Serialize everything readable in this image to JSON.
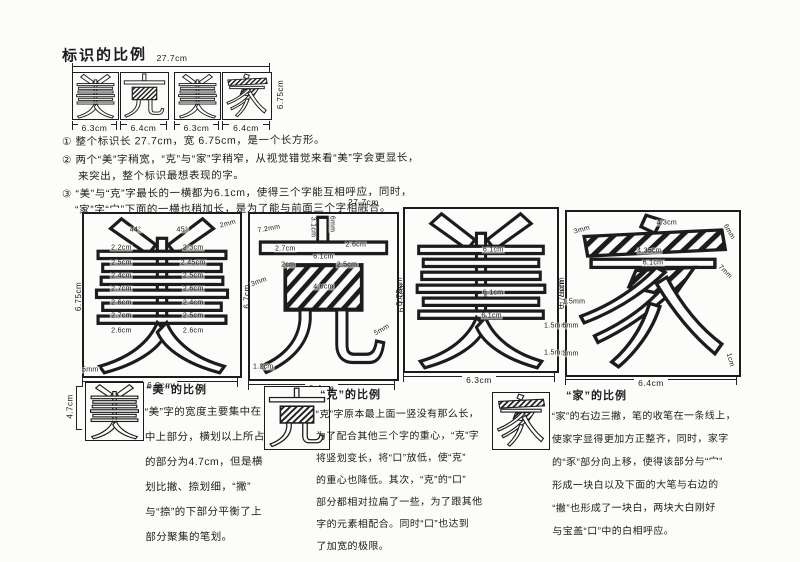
{
  "page": {
    "title": "标识的比例"
  },
  "logo_strip": {
    "width_label": "27.7cm",
    "height_label": "6.75cm",
    "characters": [
      "美",
      "克",
      "美",
      "家"
    ],
    "char_width_labels": [
      "6.3cm",
      "6.4cm",
      "6.3cm",
      "6.4cm"
    ]
  },
  "notes": {
    "n1": "① 整个标识长 27.7cm，宽 6.75cm，是一个长方形。",
    "n2a": "② 两个“美”字稍宽，“克”与“家”字稍窄，从视觉错觉来看“美”字会更显长，",
    "n2b": "来突出，整个标识最想表现的字。",
    "n3a": "③ “美”与“克”字最长的一横都为6.1cm，使得三个字能互相呼应，同时，",
    "n3b": "“家”字“宀”下面的一横也稍加长，是为了能与前面三个字相融合。",
    "n3_width": "27.7cm"
  },
  "boxes": [
    {
      "character": "美",
      "glyph": "mei",
      "left_label": "6.75cm",
      "right_label": "6.7cm",
      "bottom_label": "6.3cm",
      "labels": [
        {
          "t": "44°",
          "x": 33,
          "y": 10
        },
        {
          "t": "45°",
          "x": 63,
          "y": 10
        },
        {
          "t": "2mm",
          "x": 92,
          "y": 6,
          "r": -15
        },
        {
          "t": "2.2cm",
          "x": 24,
          "y": 21
        },
        {
          "t": "2.5cm",
          "x": 24,
          "y": 30
        },
        {
          "t": "2.4cm",
          "x": 24,
          "y": 38
        },
        {
          "t": "2.7cm",
          "x": 24,
          "y": 46
        },
        {
          "t": "2.6cm",
          "x": 24,
          "y": 55
        },
        {
          "t": "2.7cm",
          "x": 24,
          "y": 63
        },
        {
          "t": "2.6cm",
          "x": 24,
          "y": 72
        },
        {
          "t": "2.3cm",
          "x": 70,
          "y": 21
        },
        {
          "t": "2.45cm",
          "x": 70,
          "y": 30
        },
        {
          "t": "2.5cm",
          "x": 70,
          "y": 38
        },
        {
          "t": "2.6cm",
          "x": 70,
          "y": 46
        },
        {
          "t": "2.4cm",
          "x": 70,
          "y": 55
        },
        {
          "t": "2.5cm",
          "x": 70,
          "y": 63
        },
        {
          "t": "2.6cm",
          "x": 70,
          "y": 72
        },
        {
          "t": "5mm",
          "x": 4,
          "y": 96
        }
      ]
    },
    {
      "character": "克",
      "glyph": "ke",
      "right_label": "6.75cm",
      "bottom_label": "6.4cm",
      "labels": [
        {
          "t": "7.2mm",
          "x": 13,
          "y": 9,
          "r": -10
        },
        {
          "t": "3.1cm",
          "x": 43,
          "y": 8,
          "r": 90
        },
        {
          "t": "6mm",
          "x": 56,
          "y": 6,
          "r": 90
        },
        {
          "t": "2.7cm",
          "x": 24,
          "y": 21
        },
        {
          "t": "2.6cm",
          "x": 72,
          "y": 19
        },
        {
          "t": "6.1cm",
          "x": 50,
          "y": 26
        },
        {
          "t": "2cm",
          "x": 26,
          "y": 31
        },
        {
          "t": "2.5cm",
          "x": 66,
          "y": 31
        },
        {
          "t": "4.6cm",
          "x": 50,
          "y": 44
        },
        {
          "t": "3mm",
          "x": 6,
          "y": 41,
          "r": -20
        },
        {
          "t": "5mm",
          "x": 90,
          "y": 70,
          "r": -30
        },
        {
          "t": "1.2cm",
          "x": 9,
          "y": 93
        }
      ]
    },
    {
      "character": "美",
      "glyph": "mei",
      "left_label": "6.75cm",
      "right_label": "6.75cm",
      "bottom_label": "6.3cm",
      "labels": [
        {
          "t": "6.1cm",
          "x": 58,
          "y": 25
        },
        {
          "t": "6.1cm",
          "x": 58,
          "y": 52
        },
        {
          "t": "6.1cm",
          "x": 57,
          "y": 66
        },
        {
          "t": "1.5mm",
          "x": 99,
          "y": 72
        },
        {
          "t": "1.5mm",
          "x": 99,
          "y": 89
        }
      ]
    },
    {
      "character": "家",
      "glyph": "jia",
      "left_label": "6.75cm",
      "bottom_label": "6.4cm",
      "labels": [
        {
          "t": "4.3cm",
          "x": 58,
          "y": 7
        },
        {
          "t": "3mm",
          "x": 9,
          "y": 11,
          "r": -15
        },
        {
          "t": "6mm",
          "x": 94,
          "y": 12,
          "r": 60
        },
        {
          "t": "4.35cm",
          "x": 48,
          "y": 24
        },
        {
          "t": "6.1cm",
          "x": 50,
          "y": 31
        },
        {
          "t": "7mm",
          "x": 92,
          "y": 37,
          "r": 45
        },
        {
          "t": "1.5mm",
          "x": 4,
          "y": 55
        },
        {
          "t": "6mm",
          "x": 2,
          "y": 70
        },
        {
          "t": "3mm",
          "x": 2,
          "y": 87
        },
        {
          "t": "1cm",
          "x": 95,
          "y": 91,
          "r": 75
        }
      ]
    }
  ],
  "sections": [
    {
      "title": "“美”的比例",
      "character": "美",
      "height_label": "4.7cm",
      "lines": [
        "“美”字的宽度主要集中在",
        "中上部分，横划以上所占",
        "的部分为4.7cm，但是横",
        "划比撇、捺划细，“撇”",
        "与“捺”的下部分平衡了上",
        "部分聚集的笔划。"
      ]
    },
    {
      "title": "“克”的比例",
      "character": "克",
      "lines": [
        "“克”字原本最上面一竖没有那么长，",
        "为了配合其他三个字的重心，“克”字",
        "将竖划变长，将“口”放低，使“克”",
        "的重心也降低。其次，“克”的“口”",
        "部分都相对拉扁了一些，为了跟其他",
        "字的元素相配合。同时“口”也达到",
        "了加宽的极限。"
      ]
    },
    {
      "title": "“家”的比例",
      "character": "家",
      "lines": [
        "“家”的右边三撇，笔的收笔在一条线上，",
        "使家字显得更加方正整齐，同时，家字",
        "的“豕”部分向上移，使得该部分与“宀”",
        "形成一块白以及下面的大笔与右边的",
        "“撇”也形成了一块白，两块大白刚好",
        "与宝盖“口”中的白相呼应。"
      ]
    }
  ]
}
